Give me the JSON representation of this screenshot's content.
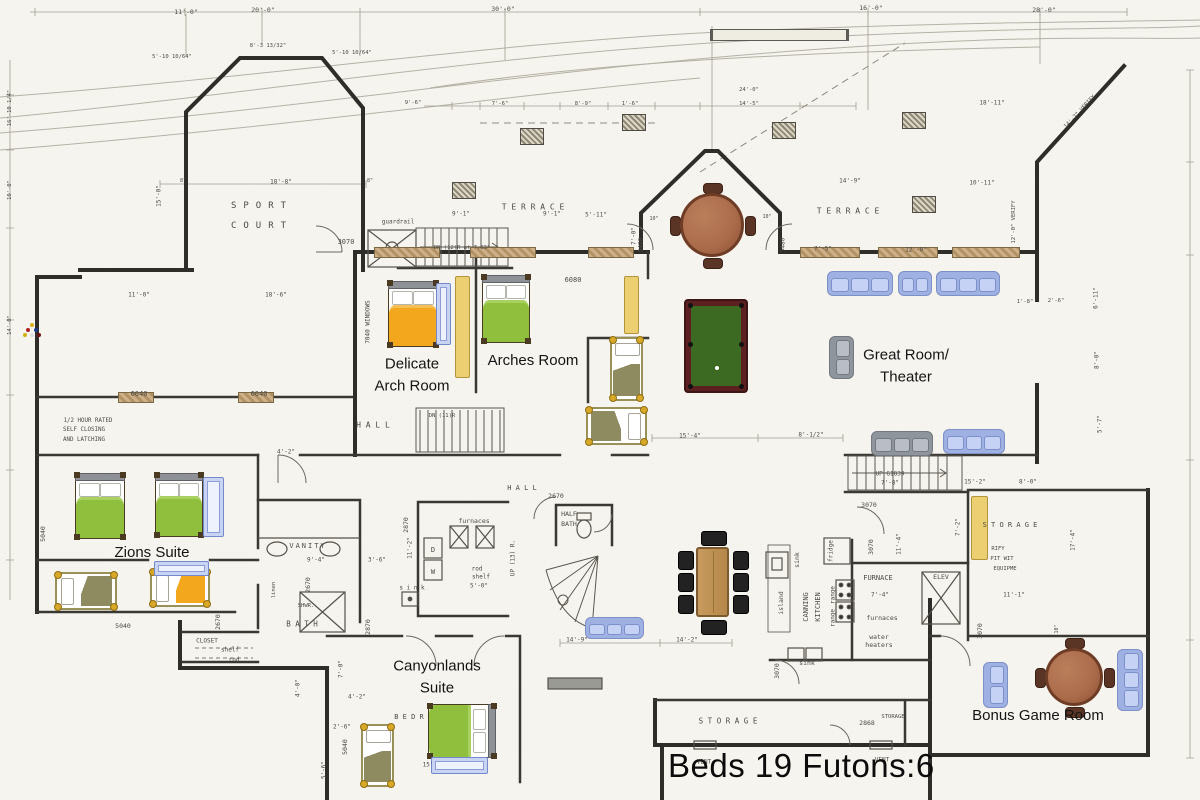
{
  "summary": {
    "beds_label": "Beds 19 Futons:6"
  },
  "palette": {
    "paper": "#f6f4ee",
    "wall": "#2f2d2a",
    "bed_green": "#8fbf3d",
    "bed_green_light": "#a9d160",
    "bed_orange": "#f2a71c",
    "bed_orange_light": "#f6bf55",
    "bed_olive": "#8f8b60",
    "futon": "#eccf70",
    "bunk": "#c9d4f2",
    "sofa_blue": "#b4c2ec",
    "sofa_gray": "#a7acb4",
    "table_brown": "#aa6b4a",
    "pool_felt": "#3c6a22",
    "pool_rail": "#5c2020",
    "dining_wood": "#c0905a"
  },
  "room_labels": [
    {
      "name": "delicate-arch-room-label",
      "lines": [
        "Delicate",
        "Arch Room"
      ],
      "x": 412,
      "y": 375,
      "s": 15
    },
    {
      "name": "arches-room-label",
      "lines": [
        "Arches Room"
      ],
      "x": 533,
      "y": 361,
      "s": 15
    },
    {
      "name": "zions-suite-label",
      "lines": [
        "Zions Suite"
      ],
      "x": 152,
      "y": 553,
      "s": 15
    },
    {
      "name": "canyonlands-suite-label",
      "lines": [
        "Canyonlands",
        "Suite"
      ],
      "x": 437,
      "y": 677,
      "s": 15
    },
    {
      "name": "great-room-label",
      "lines": [
        "Great Room/",
        "Theater"
      ],
      "x": 906,
      "y": 366,
      "s": 15
    },
    {
      "name": "bonus-game-room-label",
      "lines": [
        "Bonus Game Room"
      ],
      "x": 1038,
      "y": 716,
      "s": 15
    }
  ],
  "notes": [
    {
      "t": "SPORT",
      "x": 262,
      "y": 206,
      "s": 9,
      "ls": 7
    },
    {
      "t": "COURT",
      "x": 262,
      "y": 226,
      "s": 9,
      "ls": 7
    },
    {
      "t": "T E R R A C E",
      "x": 533,
      "y": 207,
      "s": 8
    },
    {
      "t": "T E R R A C E",
      "x": 848,
      "y": 211,
      "s": 8
    },
    {
      "t": "H A L L",
      "x": 373,
      "y": 425,
      "s": 8
    },
    {
      "t": "H A L L",
      "x": 522,
      "y": 488,
      "s": 7
    },
    {
      "t": "VANITY",
      "x": 308,
      "y": 546,
      "s": 7,
      "ls": 2
    },
    {
      "t": "B A T H",
      "x": 302,
      "y": 624,
      "s": 7.5
    },
    {
      "t": "HALF",
      "x": 569,
      "y": 514,
      "s": 6.5
    },
    {
      "t": "BATH",
      "x": 569,
      "y": 524,
      "s": 6.5
    },
    {
      "t": "CLOSET",
      "x": 207,
      "y": 641,
      "s": 6
    },
    {
      "t": "shelf",
      "x": 230,
      "y": 650,
      "s": 6
    },
    {
      "t": "rod",
      "x": 234,
      "y": 660,
      "s": 6
    },
    {
      "t": "S T O R A G E",
      "x": 728,
      "y": 721,
      "s": 7.5
    },
    {
      "t": "STORAGE",
      "x": 893,
      "y": 717,
      "s": 5.5
    },
    {
      "t": "S T O R A G E",
      "x": 1010,
      "y": 525,
      "s": 7
    },
    {
      "t": "B E D R",
      "x": 409,
      "y": 717,
      "s": 7
    },
    {
      "t": "VENT",
      "x": 704,
      "y": 762,
      "s": 6
    },
    {
      "t": "VENT",
      "x": 882,
      "y": 760,
      "s": 6
    },
    {
      "t": "FURNACE",
      "x": 878,
      "y": 578,
      "s": 7
    },
    {
      "t": "furnaces",
      "x": 882,
      "y": 618,
      "s": 6.5
    },
    {
      "t": "water",
      "x": 879,
      "y": 637,
      "s": 6.5
    },
    {
      "t": "heaters",
      "x": 879,
      "y": 645,
      "s": 6.5
    },
    {
      "t": "furnaces",
      "x": 474,
      "y": 521,
      "s": 6.5
    },
    {
      "t": "ELEV",
      "x": 941,
      "y": 577,
      "s": 6.5
    },
    {
      "t": "UP G1839",
      "x": 890,
      "y": 474,
      "s": 6
    },
    {
      "t": "7'-8\"",
      "x": 890,
      "y": 483,
      "s": 6
    },
    {
      "t": "DN (12)R at 7.83\"",
      "x": 462,
      "y": 248,
      "s": 5.5
    },
    {
      "t": "DN (11)R",
      "x": 442,
      "y": 416,
      "s": 5.5
    },
    {
      "t": "UP (13) R.",
      "x": 513,
      "y": 558,
      "s": 6,
      "r": -90
    },
    {
      "t": "guardrail",
      "x": 398,
      "y": 222,
      "s": 6
    },
    {
      "t": "1/2 HOUR RATED",
      "x": 88,
      "y": 421,
      "s": 5.8
    },
    {
      "t": "SELF CLOSING",
      "x": 84,
      "y": 430,
      "s": 5.8
    },
    {
      "t": "AND LATCHING",
      "x": 84,
      "y": 440,
      "s": 5.8
    },
    {
      "t": "7040 WINDOWS",
      "x": 368,
      "y": 322,
      "s": 6,
      "r": -90
    },
    {
      "t": "CANNING",
      "x": 806,
      "y": 607,
      "s": 7,
      "r": -90
    },
    {
      "t": "KITCHEN",
      "x": 818,
      "y": 607,
      "s": 7,
      "r": -90
    },
    {
      "t": "island",
      "x": 781,
      "y": 603,
      "s": 6.5,
      "r": -90
    },
    {
      "t": "sink",
      "x": 797,
      "y": 560,
      "s": 6.5,
      "r": -90
    },
    {
      "t": "fridge",
      "x": 831,
      "y": 551,
      "s": 6,
      "r": -90
    },
    {
      "t": "range",
      "x": 833,
      "y": 595,
      "s": 6,
      "r": -90
    },
    {
      "t": "range",
      "x": 833,
      "y": 618,
      "s": 6,
      "r": -90
    },
    {
      "t": "sink",
      "x": 807,
      "y": 663,
      "s": 6.5
    },
    {
      "t": "s i n k",
      "x": 412,
      "y": 588,
      "s": 6
    },
    {
      "t": "rod",
      "x": 477,
      "y": 569,
      "s": 6
    },
    {
      "t": "shelf",
      "x": 481,
      "y": 577,
      "s": 6
    },
    {
      "t": "5'-0\"",
      "x": 479,
      "y": 586,
      "s": 6
    },
    {
      "t": "D",
      "x": 433,
      "y": 550,
      "s": 7
    },
    {
      "t": "W",
      "x": 433,
      "y": 572,
      "s": 7
    },
    {
      "t": "SHWR.",
      "x": 306,
      "y": 606,
      "s": 5.5
    },
    {
      "t": "linen",
      "x": 274,
      "y": 590,
      "s": 5.5,
      "r": -90
    },
    {
      "t": "RIFY",
      "x": 998,
      "y": 549,
      "s": 5.5
    },
    {
      "t": "PIT WIT",
      "x": 1002,
      "y": 559,
      "s": 5.5
    },
    {
      "t": "EQUIPME",
      "x": 1005,
      "y": 569,
      "s": 5.5
    },
    {
      "t": "2868",
      "x": 867,
      "y": 723,
      "s": 6.5
    },
    {
      "t": "3070",
      "x": 346,
      "y": 242,
      "s": 7
    },
    {
      "t": "3070",
      "x": 869,
      "y": 505,
      "s": 6.5
    },
    {
      "t": "3070",
      "x": 871,
      "y": 547,
      "s": 6.5,
      "r": -90
    },
    {
      "t": "3070",
      "x": 980,
      "y": 631,
      "s": 6.5,
      "r": -90
    },
    {
      "t": "3070",
      "x": 777,
      "y": 671,
      "s": 6.5,
      "r": -90
    },
    {
      "t": "2670",
      "x": 556,
      "y": 496,
      "s": 6.5
    },
    {
      "t": "2870",
      "x": 406,
      "y": 525,
      "s": 6.5,
      "r": -90
    },
    {
      "t": "2870",
      "x": 368,
      "y": 627,
      "s": 6.5,
      "r": -90
    },
    {
      "t": "2670",
      "x": 308,
      "y": 585,
      "s": 6.5,
      "r": -90
    },
    {
      "t": "2670",
      "x": 218,
      "y": 622,
      "s": 6.5,
      "r": -90
    },
    {
      "t": "5040",
      "x": 123,
      "y": 626,
      "s": 6.5
    },
    {
      "t": "5040",
      "x": 43,
      "y": 534,
      "s": 6.5,
      "r": -90
    },
    {
      "t": "5040",
      "x": 345,
      "y": 747,
      "s": 6.5,
      "r": -90
    },
    {
      "t": "6040",
      "x": 139,
      "y": 394,
      "s": 7
    },
    {
      "t": "6040",
      "x": 259,
      "y": 394,
      "s": 7
    },
    {
      "t": "6080",
      "x": 573,
      "y": 280,
      "s": 7
    },
    {
      "t": "5480",
      "x": 641,
      "y": 245,
      "s": 6,
      "r": -90
    },
    {
      "t": "5480",
      "x": 783,
      "y": 245,
      "s": 6,
      "r": -90
    },
    {
      "t": "11'-0\"",
      "x": 186,
      "y": 12,
      "s": 6.5
    },
    {
      "t": "20'-0\"",
      "x": 263,
      "y": 10,
      "s": 6.5
    },
    {
      "t": "30'-0\"",
      "x": 503,
      "y": 9,
      "s": 6.5
    },
    {
      "t": "16'-0\"",
      "x": 871,
      "y": 8,
      "s": 6.5
    },
    {
      "t": "28'-0\"",
      "x": 1044,
      "y": 10,
      "s": 6.5
    },
    {
      "t": "5'-10 10/64\"",
      "x": 172,
      "y": 57,
      "s": 5.5
    },
    {
      "t": "8'-3 13/32\"",
      "x": 268,
      "y": 46,
      "s": 5.5
    },
    {
      "t": "5'-10 10/64\"",
      "x": 352,
      "y": 53,
      "s": 5.5
    },
    {
      "t": "18'-8\"",
      "x": 281,
      "y": 182,
      "s": 6
    },
    {
      "t": "8\"",
      "x": 183,
      "y": 181,
      "s": 5
    },
    {
      "t": "8\"",
      "x": 370,
      "y": 181,
      "s": 5
    },
    {
      "t": "15'-0\"",
      "x": 159,
      "y": 196,
      "s": 6,
      "r": -90
    },
    {
      "t": "11'-0\"",
      "x": 139,
      "y": 295,
      "s": 6
    },
    {
      "t": "18'-6\"",
      "x": 276,
      "y": 295,
      "s": 6
    },
    {
      "t": "9'-1\"",
      "x": 461,
      "y": 214,
      "s": 6
    },
    {
      "t": "9'-1\"",
      "x": 552,
      "y": 214,
      "s": 6
    },
    {
      "t": "5'-11\"",
      "x": 596,
      "y": 215,
      "s": 6
    },
    {
      "t": "7'-0\"",
      "x": 634,
      "y": 236,
      "s": 6,
      "r": -90
    },
    {
      "t": "14'-9\"",
      "x": 850,
      "y": 181,
      "s": 6
    },
    {
      "t": "7'-5\"",
      "x": 823,
      "y": 249,
      "s": 6
    },
    {
      "t": "12'-0\"",
      "x": 916,
      "y": 250,
      "s": 6
    },
    {
      "t": "10\"",
      "x": 654,
      "y": 219,
      "s": 5
    },
    {
      "t": "10\"",
      "x": 767,
      "y": 217,
      "s": 5
    },
    {
      "t": "9'-6\"",
      "x": 413,
      "y": 103,
      "s": 5.5
    },
    {
      "t": "7'-6\"",
      "x": 500,
      "y": 104,
      "s": 5.5
    },
    {
      "t": "8'-9\"",
      "x": 583,
      "y": 104,
      "s": 5.5
    },
    {
      "t": "1'-6\"",
      "x": 630,
      "y": 104,
      "s": 5.5
    },
    {
      "t": "14'-5\"",
      "x": 749,
      "y": 104,
      "s": 5.5
    },
    {
      "t": "24'-0\"",
      "x": 749,
      "y": 90,
      "s": 5.5
    },
    {
      "t": "18'-11\"",
      "x": 992,
      "y": 103,
      "s": 6
    },
    {
      "t": "10'-11\"",
      "x": 982,
      "y": 183,
      "s": 6
    },
    {
      "t": "14'-2\" VERIFY",
      "x": 1080,
      "y": 112,
      "s": 5.5,
      "r": -47
    },
    {
      "t": "12'-0\" VERIFY",
      "x": 1014,
      "y": 222,
      "s": 5.5,
      "r": -90
    },
    {
      "t": "15'-4\"",
      "x": 690,
      "y": 436,
      "s": 6
    },
    {
      "t": "8'-1/2\"",
      "x": 811,
      "y": 435,
      "s": 6
    },
    {
      "t": "14'-9\"",
      "x": 577,
      "y": 640,
      "s": 6
    },
    {
      "t": "14'-2\"",
      "x": 687,
      "y": 640,
      "s": 6
    },
    {
      "t": "15'-2\"",
      "x": 975,
      "y": 482,
      "s": 6
    },
    {
      "t": "8'-0\"",
      "x": 1028,
      "y": 482,
      "s": 6
    },
    {
      "t": "17'-4\"",
      "x": 1073,
      "y": 540,
      "s": 6,
      "r": -90
    },
    {
      "t": "11'-1\"",
      "x": 1014,
      "y": 595,
      "s": 6
    },
    {
      "t": "11'-4\"",
      "x": 899,
      "y": 544,
      "s": 6,
      "r": -90
    },
    {
      "t": "7'-4\"",
      "x": 880,
      "y": 595,
      "s": 6
    },
    {
      "t": "6'-11\"",
      "x": 1096,
      "y": 298,
      "s": 6,
      "r": -90
    },
    {
      "t": "8'-0\"",
      "x": 1097,
      "y": 360,
      "s": 6,
      "r": -90
    },
    {
      "t": "5'-7\"",
      "x": 1100,
      "y": 424,
      "s": 6,
      "r": -90
    },
    {
      "t": "1'-8\"",
      "x": 1025,
      "y": 302,
      "s": 5.5
    },
    {
      "t": "2'-6\"",
      "x": 1056,
      "y": 301,
      "s": 5.5
    },
    {
      "t": "4'-2\"",
      "x": 286,
      "y": 452,
      "s": 6
    },
    {
      "t": "9'-4\"",
      "x": 316,
      "y": 560,
      "s": 6
    },
    {
      "t": "3'-6\"",
      "x": 377,
      "y": 560,
      "s": 6
    },
    {
      "t": "11'-2\"",
      "x": 410,
      "y": 548,
      "s": 6,
      "r": -90
    },
    {
      "t": "7'-2\"",
      "x": 958,
      "y": 527,
      "s": 6,
      "r": -90
    },
    {
      "t": "4'-0\"",
      "x": 298,
      "y": 688,
      "s": 6,
      "r": -90
    },
    {
      "t": "7'-0\"",
      "x": 341,
      "y": 669,
      "s": 6,
      "r": -90
    },
    {
      "t": "4'-2\"",
      "x": 357,
      "y": 697,
      "s": 6
    },
    {
      "t": "2'-6\"",
      "x": 342,
      "y": 727,
      "s": 6
    },
    {
      "t": "5'-6\"",
      "x": 324,
      "y": 770,
      "s": 6,
      "r": -90
    },
    {
      "t": "15'",
      "x": 428,
      "y": 765,
      "s": 6
    },
    {
      "t": "10\"",
      "x": 1057,
      "y": 629,
      "s": 5,
      "r": -90
    },
    {
      "t": "16'-10 1/4\"",
      "x": 10,
      "y": 108,
      "s": 5.5,
      "r": -90
    },
    {
      "t": "10'-0\"",
      "x": 10,
      "y": 190,
      "s": 5.5,
      "r": -90
    },
    {
      "t": "14'-0\"",
      "x": 10,
      "y": 325,
      "s": 5.5,
      "r": -90
    }
  ],
  "furniture": {
    "double_beds": [
      {
        "name": "delicate-arch-bed",
        "color": "orange",
        "x": 388,
        "y": 281,
        "w": 50,
        "h": 66,
        "head": "top"
      },
      {
        "name": "arches-bed",
        "color": "green",
        "x": 482,
        "y": 275,
        "w": 48,
        "h": 68,
        "head": "top"
      },
      {
        "name": "zions-bed-1",
        "color": "green",
        "x": 75,
        "y": 473,
        "w": 50,
        "h": 66,
        "head": "top"
      },
      {
        "name": "zions-bed-2",
        "color": "green",
        "x": 155,
        "y": 473,
        "w": 48,
        "h": 64,
        "head": "top"
      },
      {
        "name": "canyonlands-bed",
        "color": "green",
        "x": 428,
        "y": 704,
        "w": 68,
        "h": 54,
        "head": "right"
      }
    ],
    "single_beds": [
      {
        "name": "hall-single-bed",
        "color": "olive",
        "x": 610,
        "y": 337,
        "w": 33,
        "h": 64,
        "head": "top"
      },
      {
        "name": "stair-single-bed",
        "color": "olive",
        "x": 586,
        "y": 407,
        "w": 61,
        "h": 38,
        "head": "right"
      },
      {
        "name": "zions-single-bed",
        "color": "olive",
        "x": 55,
        "y": 572,
        "w": 62,
        "h": 38,
        "head": "left"
      },
      {
        "name": "zions-orange-single",
        "color": "orange",
        "x": 150,
        "y": 569,
        "w": 60,
        "h": 38,
        "head": "left"
      },
      {
        "name": "canyonlands-single",
        "color": "olive",
        "x": 361,
        "y": 724,
        "w": 33,
        "h": 63,
        "head": "top"
      }
    ],
    "bunks": [
      {
        "x": 436,
        "y": 283,
        "w": 13,
        "h": 60
      },
      {
        "x": 203,
        "y": 477,
        "w": 19,
        "h": 58
      },
      {
        "x": 154,
        "y": 561,
        "w": 53,
        "h": 13
      },
      {
        "x": 431,
        "y": 757,
        "w": 55,
        "h": 15
      }
    ],
    "futons": [
      {
        "x": 455,
        "y": 276,
        "w": 13,
        "h": 100
      },
      {
        "x": 624,
        "y": 276,
        "w": 13,
        "h": 56
      },
      {
        "x": 971,
        "y": 496,
        "w": 15,
        "h": 62
      }
    ],
    "sofas": [
      {
        "color": "blue",
        "x": 827,
        "y": 271,
        "w": 66,
        "h": 25,
        "dir": "h",
        "n": 3
      },
      {
        "color": "blue",
        "x": 898,
        "y": 271,
        "w": 34,
        "h": 25,
        "dir": "h",
        "n": 2
      },
      {
        "color": "blue",
        "x": 936,
        "y": 271,
        "w": 64,
        "h": 25,
        "dir": "h",
        "n": 3
      },
      {
        "color": "gray",
        "x": 829,
        "y": 336,
        "w": 25,
        "h": 43,
        "dir": "v",
        "n": 2
      },
      {
        "color": "gray",
        "x": 871,
        "y": 431,
        "w": 62,
        "h": 25,
        "dir": "h",
        "n": 3
      },
      {
        "color": "blue",
        "x": 943,
        "y": 429,
        "w": 62,
        "h": 25,
        "dir": "h",
        "n": 3
      },
      {
        "color": "blue",
        "x": 585,
        "y": 617,
        "w": 59,
        "h": 22,
        "dir": "h",
        "n": 3
      },
      {
        "color": "blue",
        "x": 983,
        "y": 662,
        "w": 25,
        "h": 46,
        "dir": "v",
        "n": 2
      },
      {
        "color": "blue",
        "x": 1117,
        "y": 649,
        "w": 26,
        "h": 62,
        "dir": "v",
        "n": 3
      }
    ],
    "round_tables": [
      {
        "name": "terrace-table",
        "cx": 712,
        "cy": 225,
        "r": 32
      },
      {
        "name": "game-room-table",
        "cx": 1074,
        "cy": 677,
        "r": 29
      }
    ],
    "dining_set": {
      "x": 696,
      "y": 547,
      "w": 33,
      "h": 70
    },
    "pool_table": {
      "x": 684,
      "y": 299,
      "w": 64,
      "h": 94
    },
    "windows": [
      {
        "x": 374,
        "y": 247,
        "w": 64
      },
      {
        "x": 470,
        "y": 247,
        "w": 64
      },
      {
        "x": 588,
        "y": 247,
        "w": 44
      },
      {
        "x": 800,
        "y": 247,
        "w": 58
      },
      {
        "x": 878,
        "y": 247,
        "w": 58
      },
      {
        "x": 952,
        "y": 247,
        "w": 66
      },
      {
        "x": 118,
        "y": 392,
        "w": 34
      },
      {
        "x": 238,
        "y": 392,
        "w": 34
      }
    ],
    "piers": [
      {
        "x": 452,
        "y": 182
      },
      {
        "x": 520,
        "y": 128
      },
      {
        "x": 622,
        "y": 114
      },
      {
        "x": 772,
        "y": 122
      },
      {
        "x": 902,
        "y": 112
      },
      {
        "x": 912,
        "y": 196
      }
    ],
    "planter_bar": {
      "x": 710,
      "y": 29,
      "w": 133,
      "h": 10
    }
  }
}
